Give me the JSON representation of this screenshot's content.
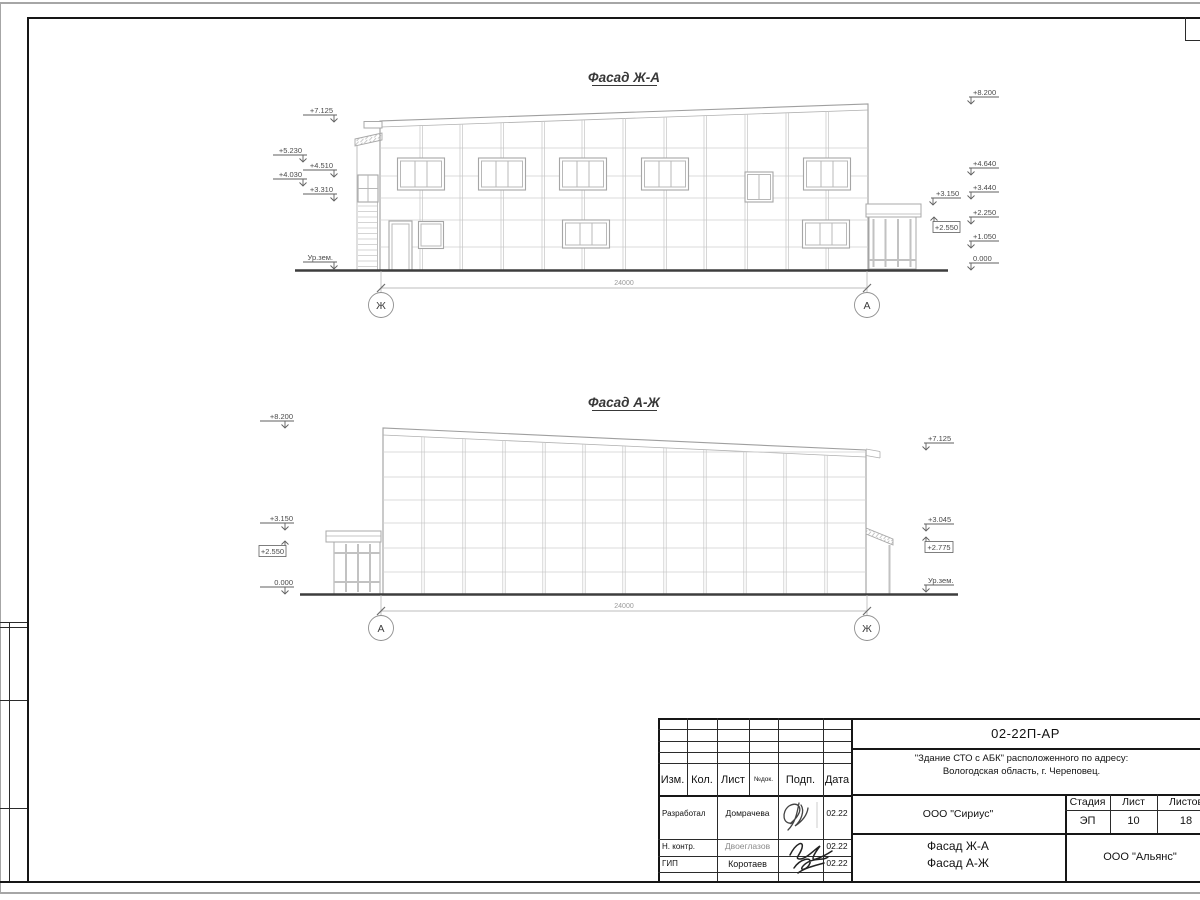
{
  "colors": {
    "ink": "#1a1a1a",
    "drawing_gray": "#b5b5b5",
    "paper": "#ffffff"
  },
  "facade_top": {
    "title": "Фасад Ж-А",
    "dim": "24000",
    "axis_left": "Ж",
    "axis_right": "А",
    "ml": {
      "m7125": "+7.125",
      "m5230": "+5.230",
      "m4510": "+4.510",
      "m4030": "+4.030",
      "m3310": "+3.310",
      "ground": "Ур.зем."
    },
    "mr": {
      "m8200": "+8.200",
      "m4640": "+4.640",
      "m3440": "+3.440",
      "m3150": "+3.150",
      "m2250": "+2.250",
      "m2550": "+2.550",
      "m1050": "+1.050",
      "m0000": "0.000"
    }
  },
  "facade_bottom": {
    "title": "Фасад А-Ж",
    "dim": "24000",
    "axis_left": "А",
    "axis_right": "Ж",
    "ml": {
      "m8200": "+8.200",
      "m3150": "+3.150",
      "m2550": "+2.550",
      "m0000": "0.000"
    },
    "mr": {
      "m7125": "+7.125",
      "m3045": "+3.045",
      "m2775": "+2.775",
      "ground": "Ур.зем."
    }
  },
  "titleblock": {
    "doc_code": "02-22П-АР",
    "project_line1": "\"Здание СТО с АБК\" расположенного по адресу:",
    "project_line2": "Вологодская область, г. Череповец.",
    "designer_org": "ООО \"Сириус\"",
    "customer_org": "ООО \"Альянс\"",
    "titles_line1": "Фасад Ж-А",
    "titles_line2": "Фасад А-Ж",
    "cols": {
      "izm": "Изм.",
      "kol": "Кол.",
      "list": "Лист",
      "ndok": "№док.",
      "podp": "Подп.",
      "data": "Дата"
    },
    "stage": {
      "label": "Стадия",
      "value": "ЭП"
    },
    "sheet": {
      "label": "Лист",
      "value": "10"
    },
    "sheets": {
      "label": "Листов",
      "value": "18"
    },
    "rows": [
      {
        "role": "Разработал",
        "name": "Домрачева",
        "date": "02.22"
      },
      {
        "role": "Н. контр.",
        "name": "Двоеглазов",
        "date": "02.22"
      },
      {
        "role": "ГИП",
        "name": "Коротаев",
        "date": "02.22"
      }
    ]
  }
}
